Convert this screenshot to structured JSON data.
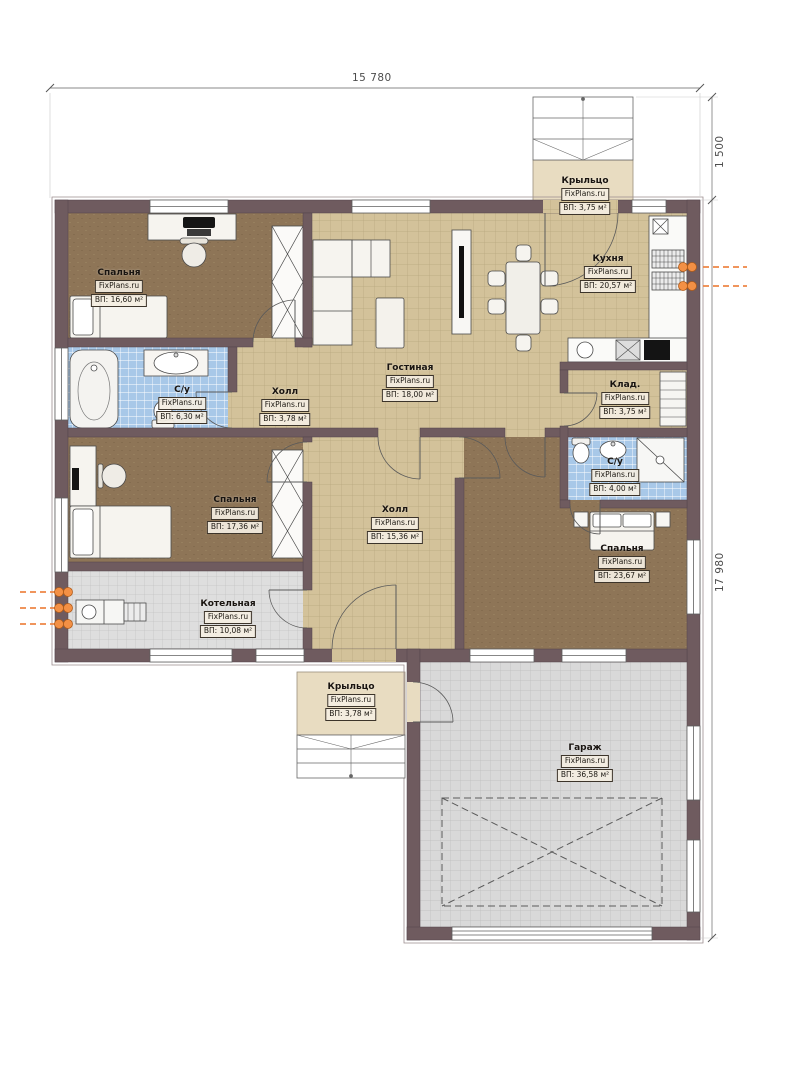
{
  "watermark": "FixPlans.ru",
  "dimensions": {
    "top_width": "15 780",
    "porch_depth": "1 500",
    "right_height": "17 980"
  },
  "rooms": [
    {
      "id": "bedroom-top-left",
      "name": "Спальня",
      "area": "ВП: 16,60 м²"
    },
    {
      "id": "bathroom-left",
      "name": "С/у",
      "area": "ВП: 6,30 м²"
    },
    {
      "id": "hall-small",
      "name": "Холл",
      "area": "ВП: 3,78 м²"
    },
    {
      "id": "living-room",
      "name": "Гостиная",
      "area": "ВП: 18,00 м²"
    },
    {
      "id": "kitchen",
      "name": "Кухня",
      "area": "ВП: 20,57 м²"
    },
    {
      "id": "storage",
      "name": "Клад.",
      "area": "ВП: 3,75 м²"
    },
    {
      "id": "bathroom-right",
      "name": "С/у",
      "area": "ВП: 4,00 м²"
    },
    {
      "id": "bedroom-mid-left",
      "name": "Спальня",
      "area": "ВП: 17,36 м²"
    },
    {
      "id": "hall-central",
      "name": "Холл",
      "area": "ВП: 15,36 м²"
    },
    {
      "id": "boiler-room",
      "name": "Котельная",
      "area": "ВП: 10,08 м²"
    },
    {
      "id": "bedroom-right",
      "name": "Спальня",
      "area": "ВП: 23,67 м²"
    },
    {
      "id": "porch-top",
      "name": "Крыльцо",
      "area": "ВП: 3,75 м²"
    },
    {
      "id": "porch-bottom",
      "name": "Крыльцо",
      "area": "ВП: 3,78 м²"
    },
    {
      "id": "garage",
      "name": "Гараж",
      "area": "ВП: 36,58 м²"
    }
  ],
  "colors": {
    "wall": "#6f5b5f",
    "floor_wood": "#8e7557",
    "floor_tile_beige": "#d3c29a",
    "floor_tile_blue": "#a8c8e8",
    "floor_tile_gray": "#dedede",
    "porch_slab": "#e8dcc1",
    "utility_orange": "#f28c3e"
  }
}
